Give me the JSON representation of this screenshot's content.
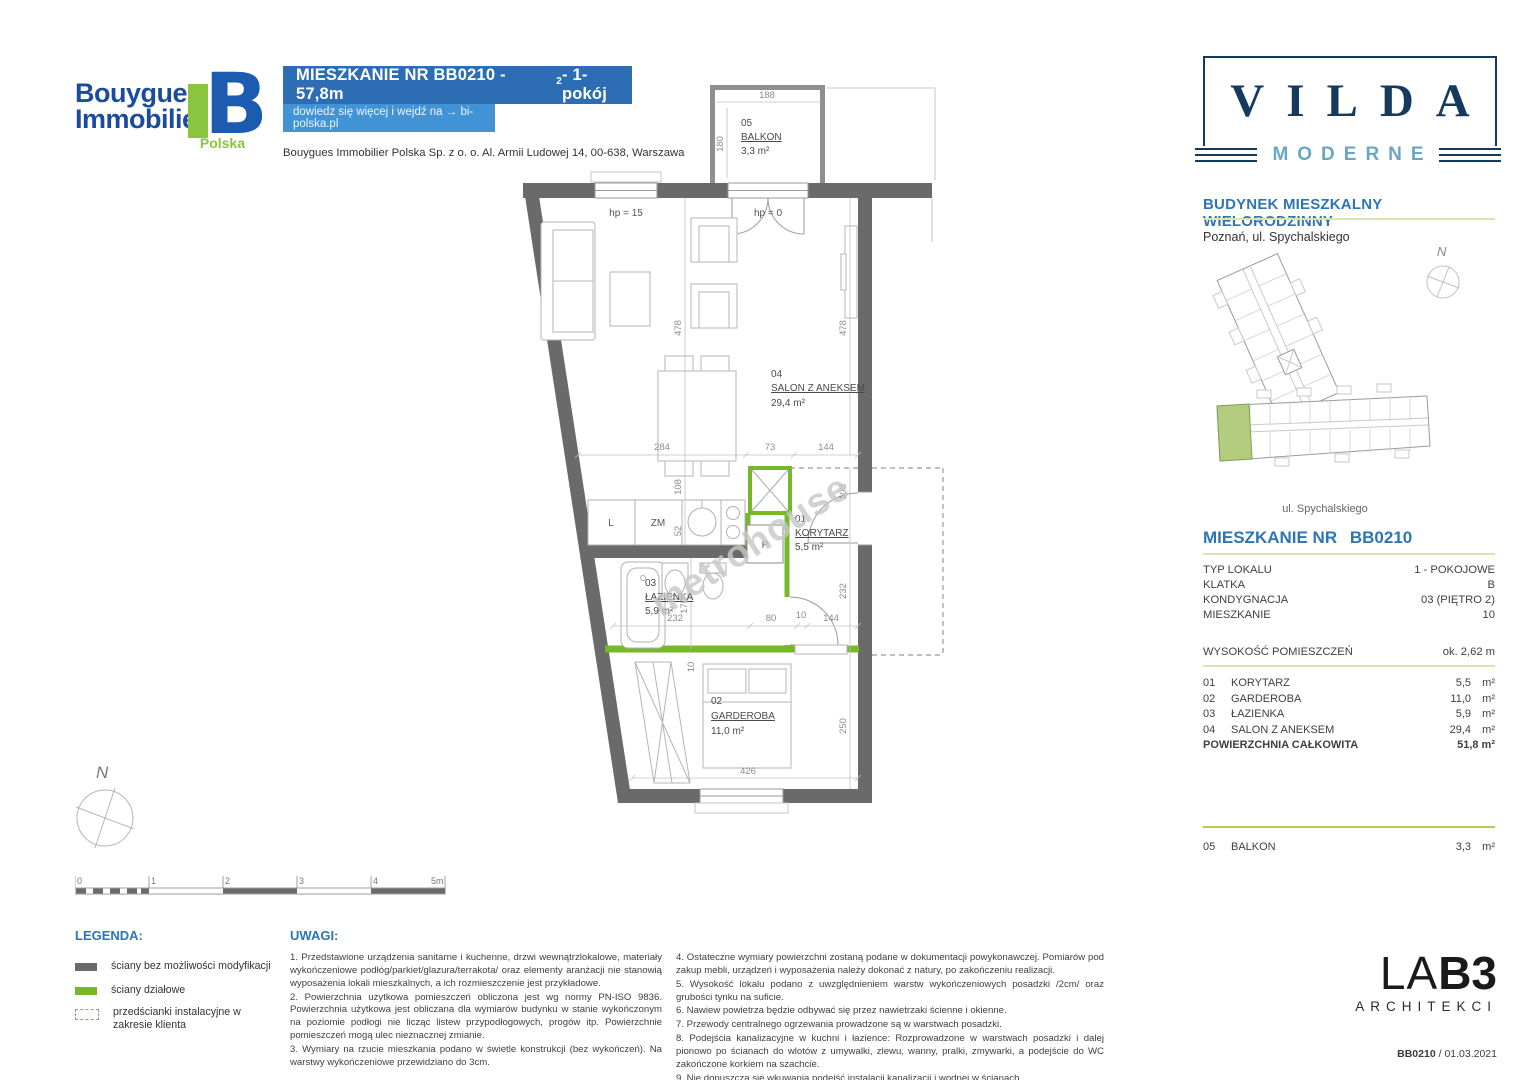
{
  "header": {
    "brand_line1": "Bouygues",
    "brand_line2": "Immobilier",
    "brand_country": "Polska",
    "brand_mark": "B",
    "title_pre": "MIESZKANIE NR BB0210 -  57,8m",
    "title_sup": "2",
    "title_post": " - 1-pokój",
    "link_text": "dowiedz się więcej i wejdź na → bi-polska.pl",
    "address": "Bouygues Immobilier Polska Sp. z o. o. Al. Armii Ludowej 14, 00-638, Warszawa"
  },
  "plan": {
    "watermark": "metrohouse",
    "hp_left": "hp = 15",
    "hp_right": "hp = 0",
    "kitchen": {
      "fridge": "L",
      "dishwasher": "ZM",
      "washer": "P"
    },
    "rooms": [
      {
        "no": "01",
        "name": "KORYTARZ",
        "area": "5,5 m²"
      },
      {
        "no": "02",
        "name": "GARDEROBA",
        "area": "11,0 m²"
      },
      {
        "no": "03",
        "name": "ŁAZIENKA",
        "area": "5,9 m²"
      },
      {
        "no": "04",
        "name": "SALON Z ANEKSEM",
        "area": "29,4 m²"
      },
      {
        "no": "05",
        "name": "BALKON",
        "area": "3,3 m²"
      }
    ],
    "dims": {
      "b188": "188",
      "b180": "180",
      "l478": "478",
      "r478": "478",
      "w284": "284",
      "w73": "73",
      "w144": "144",
      "l108": "108",
      "r108": "108",
      "l52": "52",
      "l170": "170",
      "w232": "232",
      "w80": "80",
      "w10": "10",
      "w144b": "144",
      "r232": "232",
      "l10": "10",
      "r250": "250",
      "w426": "426"
    }
  },
  "compass": {
    "label": "N"
  },
  "scalebar": {
    "labels": [
      "0",
      "1",
      "2",
      "3",
      "4",
      "5m"
    ]
  },
  "sidebar": {
    "logo_title": "VILDA",
    "logo_subtitle": "MODERNE",
    "building_heading": "BUDYNEK MIESZKALNY WIELORODZINNY",
    "location": "Poznań, ul. Spychalskiego",
    "compass": "N",
    "street_label": "ul. Spychalskiego",
    "apt_heading_label": "MIESZKANIE NR",
    "apt_heading_no": "BB0210",
    "info_rows": [
      {
        "label": "TYP LOKALU",
        "value": "1 - POKOJOWE"
      },
      {
        "label": "KLATKA",
        "value": "B"
      },
      {
        "label": "KONDYGNACJA",
        "value": "03 (PIĘTRO 2)"
      },
      {
        "label": "MIESZKANIE",
        "value": "10"
      }
    ],
    "height_label": "WYSOKOŚĆ POMIESZCZEŃ",
    "height_value": "ok. 2,62 m",
    "rooms": [
      {
        "no": "01",
        "name": "KORYTARZ",
        "value": "5,5",
        "unit": "m²"
      },
      {
        "no": "02",
        "name": "GARDEROBA",
        "value": "11,0",
        "unit": "m²"
      },
      {
        "no": "03",
        "name": "ŁAZIENKA",
        "value": "5,9",
        "unit": "m²"
      },
      {
        "no": "04",
        "name": "SALON Z ANEKSEM",
        "value": "29,4",
        "unit": "m²"
      }
    ],
    "total_label": "POWIERZCHNIA CAŁKOWITA",
    "total_value": "51,8 m²",
    "balcony_row": {
      "no": "05",
      "name": "BALKON",
      "value": "3,3",
      "unit": "m²"
    },
    "lab3_la": "LA",
    "lab3_b3": "B3",
    "lab3_sub": "ARCHITEKCI",
    "doc_id": "BB0210",
    "doc_sep": " / ",
    "doc_date": "01.03.2021"
  },
  "footer": {
    "legend_title": "LEGENDA:",
    "legend_items": [
      {
        "label": "ściany bez możliwości modyfikacji"
      },
      {
        "label": "ściany działowe"
      },
      {
        "label": "przedścianki instalacyjne w zakresie klienta"
      }
    ],
    "uwagi_title": "UWAGI:",
    "notes_left": [
      "1.  Przedstawione  urządzenia  sanitarne  i  kuchenne,  drzwi  wewnątrzlokalowe,  materiały wykończeniowe podłóg/parkiet/glazura/terrakota/ oraz elementy aranżacji nie stanowią wyposażenia lokali mieszkalnych, a ich rozmieszczenie jest przykładowe.",
      "2. Powierzchnia użytkowa pomieszczeń obliczona jest wg normy PN-ISO 9836. Powierzchnia użytkowa jest obliczana dla wymiarów budynku w stanie wykończonym na poziomie podłogi nie licząc listew przypodłogowych, progów itp. Powierzchnie pomieszczeń mogą ulec nieznacznej zmianie.",
      "3. Wymiary na rzucie mieszkania podano w świetle konstrukcji (bez wykończeń). Na warstwy wykończeniowe przewidziano do 3cm."
    ],
    "notes_right": [
      "4. Ostateczne wymiary powierzchni zostaną podane w dokumentacji powykonawczej. Pomiarów pod zakup mebli, urządzeń i wyposażenia należy dokonać z natury, po zakończeniu realizacji.",
      "5. Wysokość lokalu podano z uwzględnieniem warstw wykończeniowych posadzki /2cm/ oraz grubości tynku na suficie.",
      "6. Nawiew powietrza będzie odbywać się przez nawietrzaki ścienne i okienne.",
      "7. Przewody centralnego ogrzewania prowadzone są w warstwach posadzki.",
      "8. Podejścia kanalizacyjne w kuchni i łazience: Rozprowadzone w warstwach posadzki i dalej pionowo po ścianach do wlotów z umywalki, zlewu, wanny, pralki, zmywarki, a podejście do WC zakończone korkiem na szachcie.",
      "9. Nie dopuszcza się wkuwania podejść instalacji kanalizacji i wodnej w ścianach.",
      "10. Niedopuszczalna jest ingerencja w elementy nośne budynku."
    ]
  }
}
